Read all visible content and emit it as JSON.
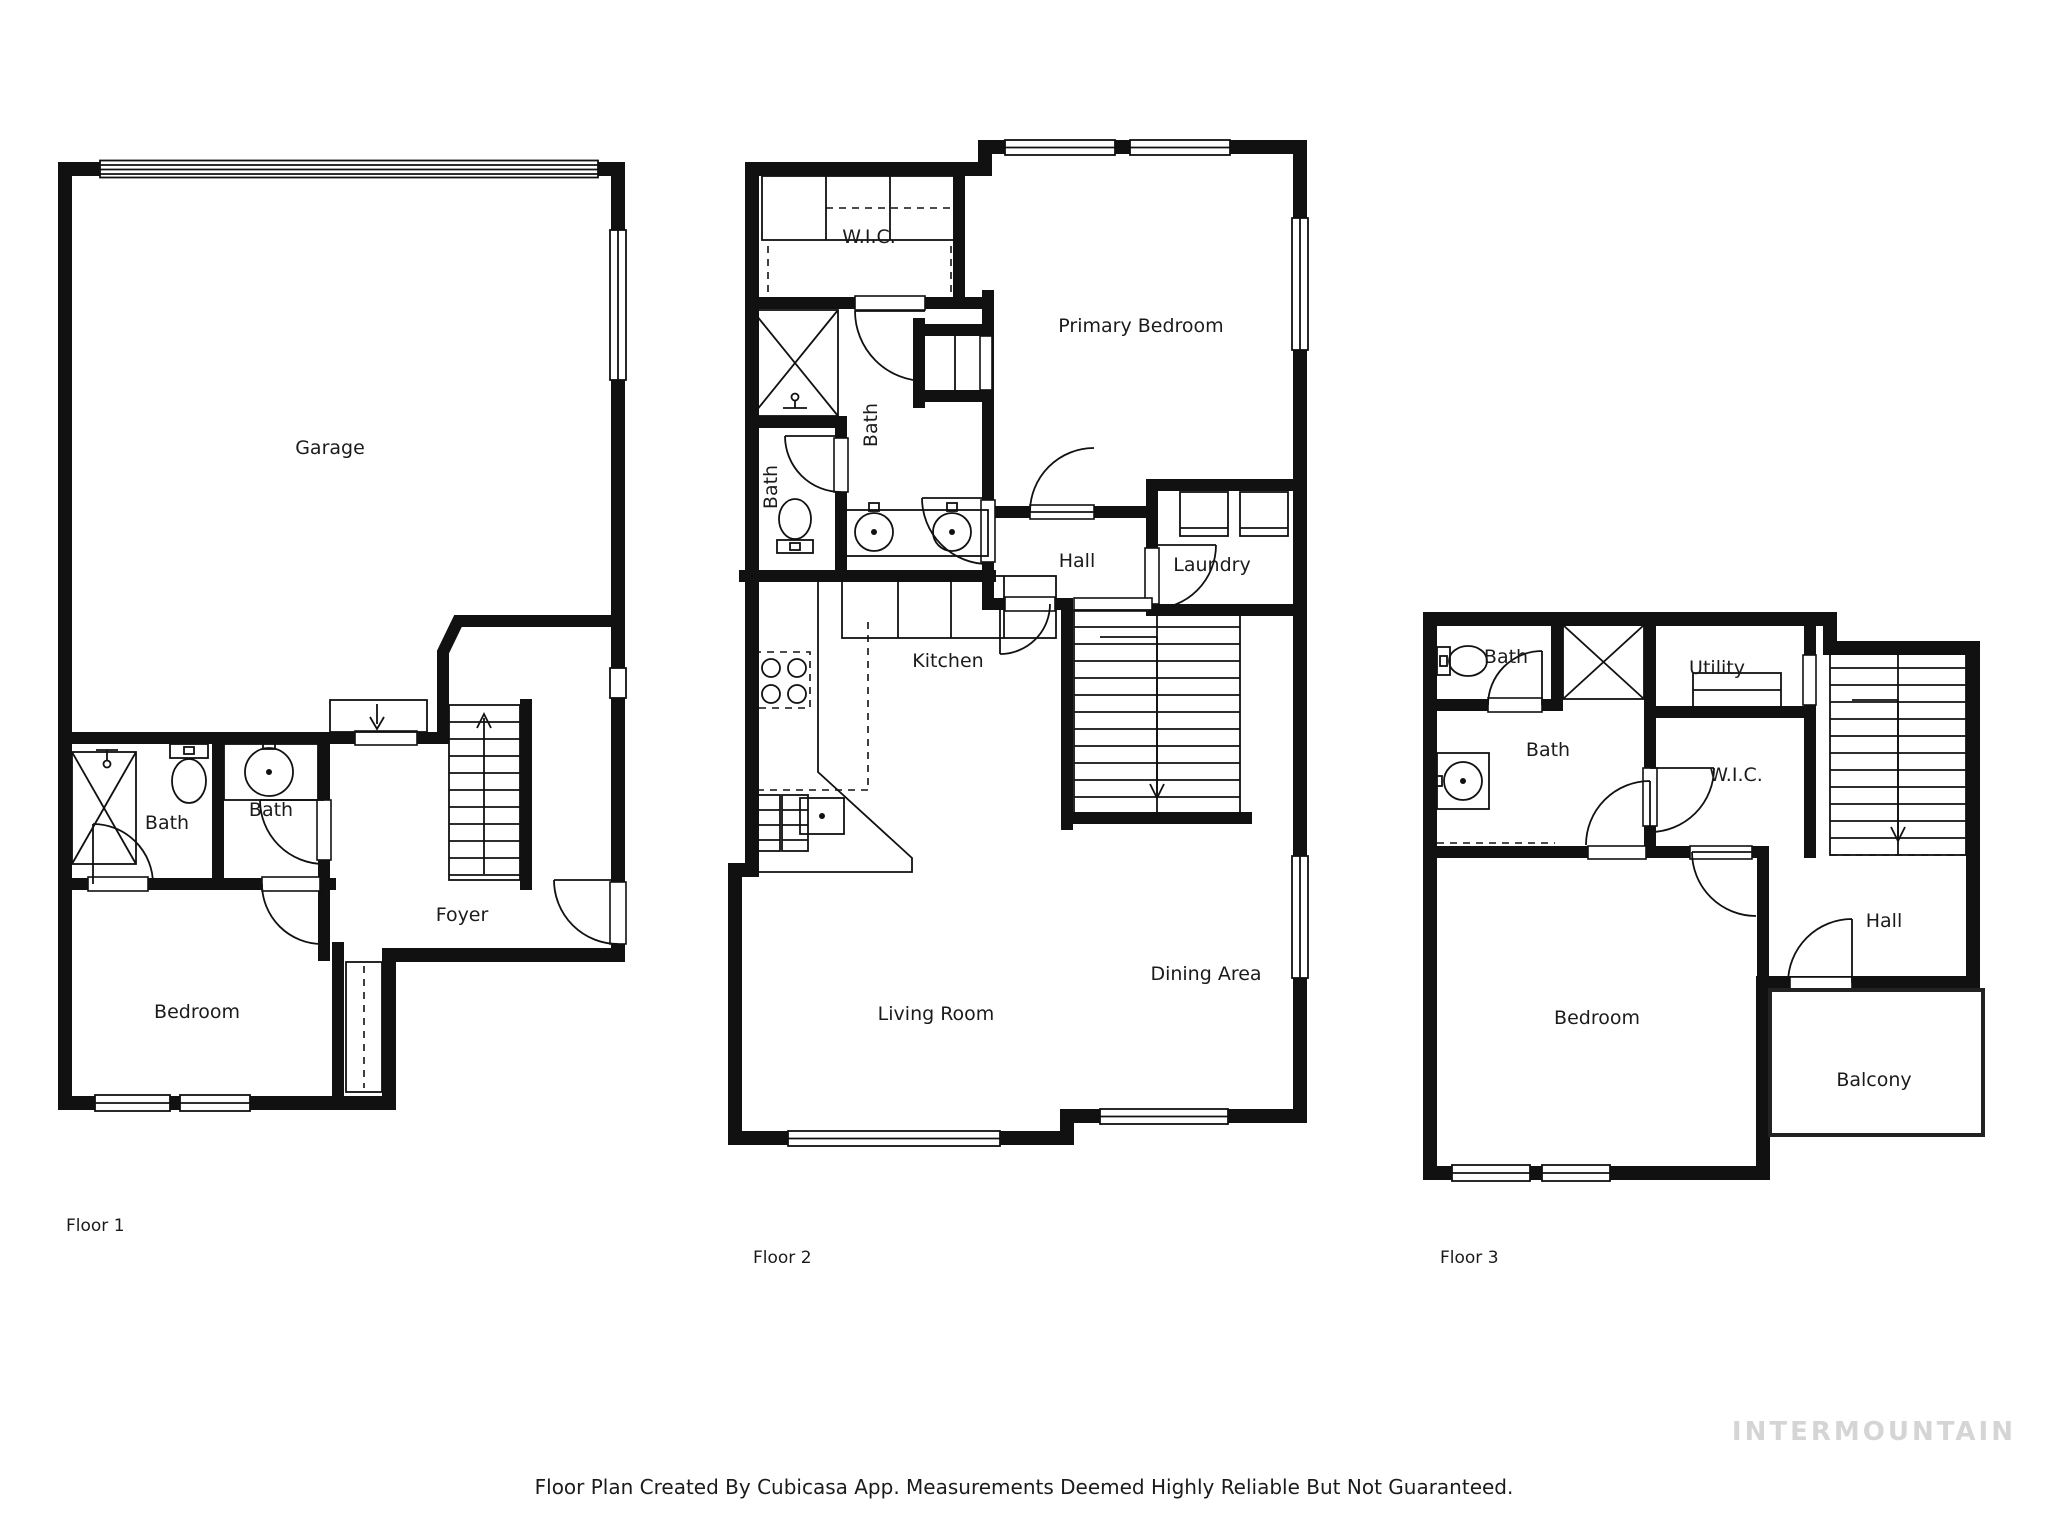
{
  "floor1": {
    "label": "Floor 1",
    "rooms": {
      "garage": "Garage",
      "bath_left": "Bath",
      "bath_right": "Bath",
      "bedroom": "Bedroom",
      "foyer": "Foyer"
    }
  },
  "floor2": {
    "label": "Floor 2",
    "rooms": {
      "wic": "W.I.C.",
      "primary_bedroom": "Primary Bedroom",
      "bath_small": "Bath",
      "bath_main": "Bath",
      "hall": "Hall",
      "laundry": "Laundry",
      "kitchen": "Kitchen",
      "dining": "Dining Area",
      "living": "Living Room"
    }
  },
  "floor3": {
    "label": "Floor 3",
    "rooms": {
      "bath_top": "Bath",
      "bath_main": "Bath",
      "utility": "Utility",
      "wic": "W.I.C.",
      "hall": "Hall",
      "bedroom": "Bedroom",
      "balcony": "Balcony"
    }
  },
  "footer": {
    "caption": "Floor Plan Created By Cubicasa App. Measurements Deemed Highly Reliable But Not Guaranteed."
  },
  "watermark": {
    "text": "INTERMOUNTAIN"
  },
  "colors": {
    "wall": "#111111",
    "watermark_gray": "#d5d5d5",
    "background": "#ffffff"
  }
}
